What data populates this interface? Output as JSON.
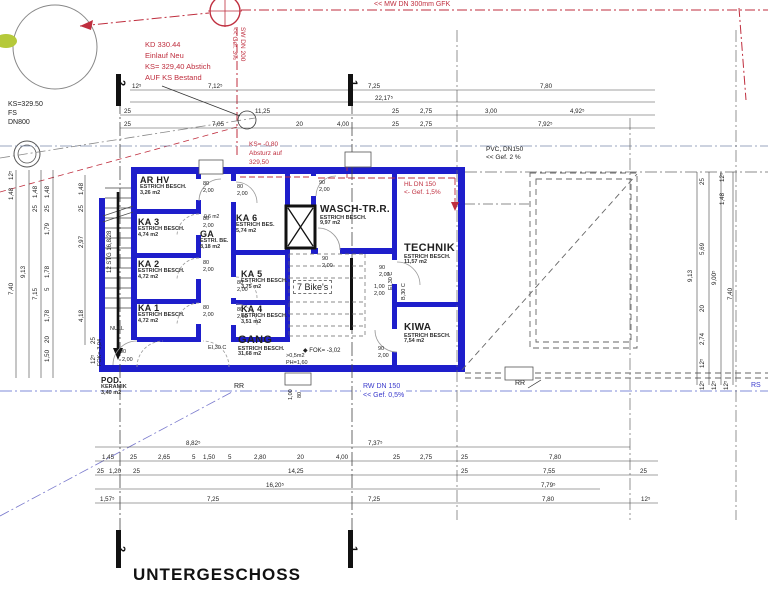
{
  "meta": {
    "title": "UNTERGESCHOSS"
  },
  "colors": {
    "wall": "#1e1ecb",
    "red_note": "#bf2e3e",
    "blue_note": "#3a3acc",
    "line": "#555555"
  },
  "rooms": [
    {
      "name": "AR HV",
      "line1": "ESTRICH BESCH.",
      "line2": "3,26 m2"
    },
    {
      "name": "KA 3",
      "line1": "ESTRICH BESCH.",
      "line2": "4,74 m2"
    },
    {
      "name": "KA 2",
      "line1": "ESTRICH BESCH.",
      "line2": "4,72 m2"
    },
    {
      "name": "KA 1",
      "line1": "ESTRICH BESCH.",
      "line2": "4,72 m2"
    },
    {
      "name": "GA",
      "line1": "ESTRI. BE.",
      "line2": "8,18 m2"
    },
    {
      "name": "KA 6",
      "line1": "ESTRICH BES.",
      "line2": "5,74 m2"
    },
    {
      "name": "KA 5",
      "line1": "ESTRICH BESCH.",
      "line2": "3,75 m2"
    },
    {
      "name": "KA 4",
      "line1": "ESTRICH BESCH.",
      "line2": "3,51 m2"
    },
    {
      "name": "WASCH-TR.R.",
      "line1": "ESTRICH BESCH.",
      "line2": "9,97 m2"
    },
    {
      "name": "TECHNIK",
      "line1": "ESTRICH BESCH.",
      "line2": "11,57 m2"
    },
    {
      "name": "KIWA",
      "line1": "ESTRICH BESCH.",
      "line2": "7,54 m2"
    },
    {
      "name": "GANG",
      "line1": "ESTRICH BESCH.",
      "line2": "31,68 m2"
    },
    {
      "name": "POD.",
      "line1": "KERAMIK",
      "line2": "3,40 m2"
    }
  ],
  "notes": {
    "kd": [
      "KD   330.44",
      "Einlauf Neu",
      "KS= 329,40 Abstich",
      "AUF KS Bestand"
    ],
    "sw": [
      "SW DN 200",
      "<< Gef. 3%"
    ],
    "mw": "<< MW DN 300mm GFK",
    "ks_top": [
      "KS=329.50",
      "FS",
      "DN800"
    ],
    "absturz": [
      "KS= -0,80",
      "Absturz auf",
      "329,50"
    ],
    "pvc": [
      "PVC, DN150",
      "<< Gef. 2 %"
    ],
    "hl": [
      "HL DN 150",
      "<- Gef. 1,5%"
    ],
    "rw": [
      "RW DN 150",
      "<< Gef. 0,5%"
    ],
    "rr": "RR",
    "rs": "RS",
    "fok_gang": "FOK= -3,02",
    "fok_stair": "FOK=-3,04",
    "null_mark": "NULL",
    "stg": "12 STG 16,8/28",
    "win": [
      ">0,5m2",
      "PH=1,60"
    ],
    "small_area": "0,6 m2",
    "bike": "7 Bike's",
    "lvl_diamond": "◆"
  },
  "sections": {
    "one": "1",
    "two": "2"
  },
  "dims": {
    "top1": [
      "12⁵",
      "7,12⁵",
      "7,25",
      "7,80"
    ],
    "top2": [
      "22,17⁵"
    ],
    "top3": [
      "25",
      "11,25",
      "25",
      "2,75",
      "3,00",
      "4,92⁵"
    ],
    "top4": [
      "25",
      "7,05",
      "20",
      "4,00",
      "25",
      "2,75",
      "7,92⁵"
    ],
    "bot1": [
      "8,82⁵",
      "7,37⁵"
    ],
    "bot2": [
      "1,45",
      "25",
      "2,65",
      "5",
      "1,50",
      "5",
      "2,80",
      "20",
      "4,00",
      "25",
      "2,75",
      "25",
      "7,80"
    ],
    "bot3": [
      "25",
      "1,20",
      "25",
      "14,25",
      "25",
      "7,55",
      "25"
    ],
    "bot4": [
      "16,20⁵",
      "7,79⁵"
    ],
    "bot5": [
      "1,57⁵",
      "7,25",
      "7,25",
      "7,80",
      "12⁵"
    ],
    "left": [
      "12⁵",
      "1,48",
      "7,40",
      "9,13",
      "1,48",
      "25",
      "7,15",
      "1,48",
      "25",
      "1,79",
      "1,78",
      "5",
      "1,78",
      "20",
      "1,50",
      "1,48",
      "25",
      "2,97",
      "4,18",
      "25",
      "12⁵"
    ],
    "right": [
      "25",
      "12⁵",
      "1,48",
      "5,69",
      "9,13",
      "9,00⁵",
      "7,40",
      "20",
      "2,74",
      "12⁵",
      "12⁵",
      "12⁵",
      "12⁵"
    ],
    "door": {
      "w80": "80",
      "w90": "90",
      "h200": "2,00",
      "h100": "1,00",
      "ei30": "EI,30 C",
      "b30": "B,30 C"
    }
  }
}
